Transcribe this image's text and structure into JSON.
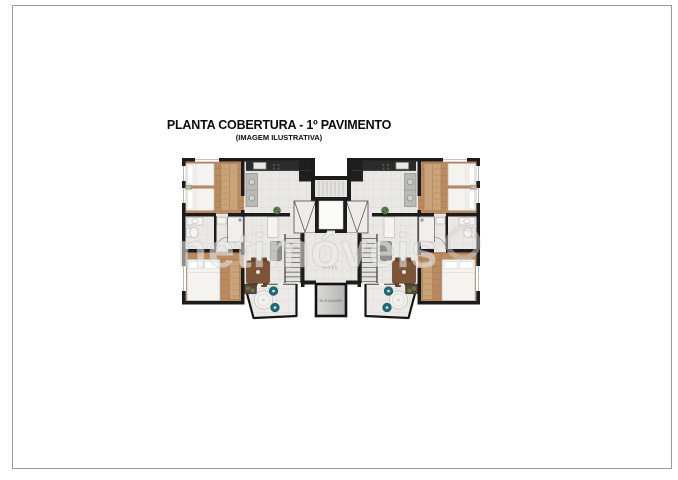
{
  "header": {
    "title": "PLANTA COBERTURA - 1º PAVIMENTO",
    "subtitle": "(IMAGEM ILUSTRATIVA)"
  },
  "plan": {
    "hall_label": "HALL",
    "elevator_label": "ELEVADOR"
  },
  "watermark": {
    "text": "netimóveis"
  },
  "colors": {
    "wall": "#1c1c1c",
    "wood": "#bb8a60",
    "tile": "#e9e8e5",
    "balcony_tile": "#eceae6",
    "counter": "#2b2b2b",
    "table_wood": "#7d5436",
    "chair_teal": "#1e6b7a",
    "fixture": "#f4f3f0",
    "wardrobe": "#c9a478",
    "plant": "#5c7d4e",
    "watermark": "#ececec",
    "border": "#9b9b9b",
    "ink": "#0c0c0c"
  }
}
